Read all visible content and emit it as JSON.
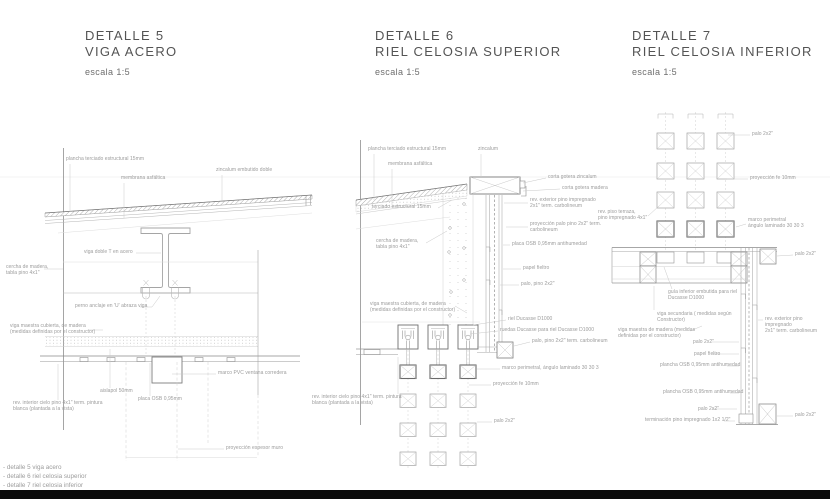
{
  "sheet": {
    "background": "#ffffff",
    "title_color": "#545454",
    "label_color": "#9c9c9c",
    "line_color": "#9a9a9a",
    "bar_color": "#0a0a0a"
  },
  "details": [
    {
      "title_line1": "DETALLE 5",
      "title_line2": "VIGA ACERO",
      "scale": "escala 1:5"
    },
    {
      "title_line1": "DETALLE 6",
      "title_line2": "RIEL CELOSIA SUPERIOR",
      "scale": "escala 1:5"
    },
    {
      "title_line1": "DETALLE 7",
      "title_line2": "RIEL CELOSIA INFERIOR",
      "scale": "escala 1:5"
    }
  ],
  "legend": {
    "items": [
      "- detalle 5 viga acero",
      "- detalle 6 riel celosia superior",
      "- detalle 7 riel celosia inferior"
    ]
  },
  "annotations": [
    {
      "x": 66,
      "y": 157,
      "text": "plancha terciado estructural 15mm"
    },
    {
      "x": 121,
      "y": 176,
      "text": "membrana asfáltica"
    },
    {
      "x": 216,
      "y": 168,
      "text": "zincalum embutido doble"
    },
    {
      "x": 84,
      "y": 250,
      "text": "viga doble T en acero"
    },
    {
      "x": 6,
      "y": 265,
      "text": "cercha de madera,\ntabla pino 4x1\""
    },
    {
      "x": 75,
      "y": 304,
      "text": "perno anclaje en 'U' abraza viga"
    },
    {
      "x": 10,
      "y": 324,
      "text": "viga maestra cubierta,  de madera\n(medidas definidas por el constructor)"
    },
    {
      "x": 218,
      "y": 371,
      "text": "marco PVC ventana corredera"
    },
    {
      "x": 100,
      "y": 389,
      "text": "aislapol 50mm"
    },
    {
      "x": 138,
      "y": 397,
      "text": "placa OSB 0,95mm"
    },
    {
      "x": 13,
      "y": 401,
      "text": "rev. interior cielo pino 4x1\" term. pintura\nblanca (plantada a la vista)"
    },
    {
      "x": 226,
      "y": 446,
      "text": "proyección espesor muro"
    },
    {
      "x": 368,
      "y": 147,
      "text": "plancha terciado estructural 15mm"
    },
    {
      "x": 478,
      "y": 147,
      "text": "zincalum"
    },
    {
      "x": 388,
      "y": 162,
      "text": "membrana asfáltica"
    },
    {
      "x": 548,
      "y": 175,
      "text": "corta gotera zincalum"
    },
    {
      "x": 562,
      "y": 186,
      "text": "corta gotera madera"
    },
    {
      "x": 372,
      "y": 205,
      "text": "terciado estructural 15mm"
    },
    {
      "x": 530,
      "y": 198,
      "text": "rev. exterior pino impregnado\n2x1\" term. carbolineum"
    },
    {
      "x": 376,
      "y": 239,
      "text": "cercha de madera,\ntabla pino 4x1\""
    },
    {
      "x": 530,
      "y": 222,
      "text": "proyección palo pino 2x2\" term.\ncarbolineum"
    },
    {
      "x": 512,
      "y": 242,
      "text": "placa OSB 0,95mm antihumedad"
    },
    {
      "x": 523,
      "y": 266,
      "text": "papel fieltro"
    },
    {
      "x": 521,
      "y": 282,
      "text": "palo, pino 2x2\""
    },
    {
      "x": 370,
      "y": 302,
      "text": "viga maestra cubierta,  de madera\n(medidas definidas por el constructor)"
    },
    {
      "x": 508,
      "y": 317,
      "text": "riel Ducasse D1000"
    },
    {
      "x": 500,
      "y": 328,
      "text": "ruedas Ducasse para riel Ducasse D1000"
    },
    {
      "x": 532,
      "y": 339,
      "text": "palo, pino 2x2\" term. carbolineum"
    },
    {
      "x": 502,
      "y": 366,
      "text": "marco perimetral, ángulo laminado 30 30 3"
    },
    {
      "x": 493,
      "y": 382,
      "text": "proyección fe 10mm"
    },
    {
      "x": 312,
      "y": 395,
      "text": "rev. interior cielo pino 4x1\" term. pintura\nblanca (plantada a la vista)"
    },
    {
      "x": 494,
      "y": 419,
      "text": "palo 2x2\""
    },
    {
      "x": 752,
      "y": 132,
      "text": "palo 2x2\""
    },
    {
      "x": 750,
      "y": 176,
      "text": "proyección fe 10mm"
    },
    {
      "x": 748,
      "y": 218,
      "text": "marco perimetral\nángulo laminado 30 30 3"
    },
    {
      "x": 598,
      "y": 210,
      "text": "rev. piso terraza,\npino impregnado 4x1\""
    },
    {
      "x": 795,
      "y": 252,
      "text": "palo 2x2\""
    },
    {
      "x": 668,
      "y": 290,
      "text": "guía inferior embutida para riel\nDucasse D1000"
    },
    {
      "x": 657,
      "y": 312,
      "text": "viga secundaria ( medidas según\nConstructor)"
    },
    {
      "x": 618,
      "y": 328,
      "text": "viga maestra de madera (medidas\ndefinidas por el constructor)"
    },
    {
      "x": 765,
      "y": 317,
      "text": "rev. exterior pino impregnado\n2x1\" term. carbolineum"
    },
    {
      "x": 693,
      "y": 340,
      "text": "palo 2x2\""
    },
    {
      "x": 694,
      "y": 352,
      "text": "papel fieltro"
    },
    {
      "x": 660,
      "y": 363,
      "text": "plancha OSB 0,95mm antihumedad"
    },
    {
      "x": 663,
      "y": 390,
      "text": "plancha OSB 0,95mm antihumedad"
    },
    {
      "x": 698,
      "y": 407,
      "text": "palo 2x2\""
    },
    {
      "x": 645,
      "y": 418,
      "text": "terminación pino impregnado 1x2 1/2\""
    },
    {
      "x": 795,
      "y": 413,
      "text": "palo 2x2\""
    }
  ]
}
